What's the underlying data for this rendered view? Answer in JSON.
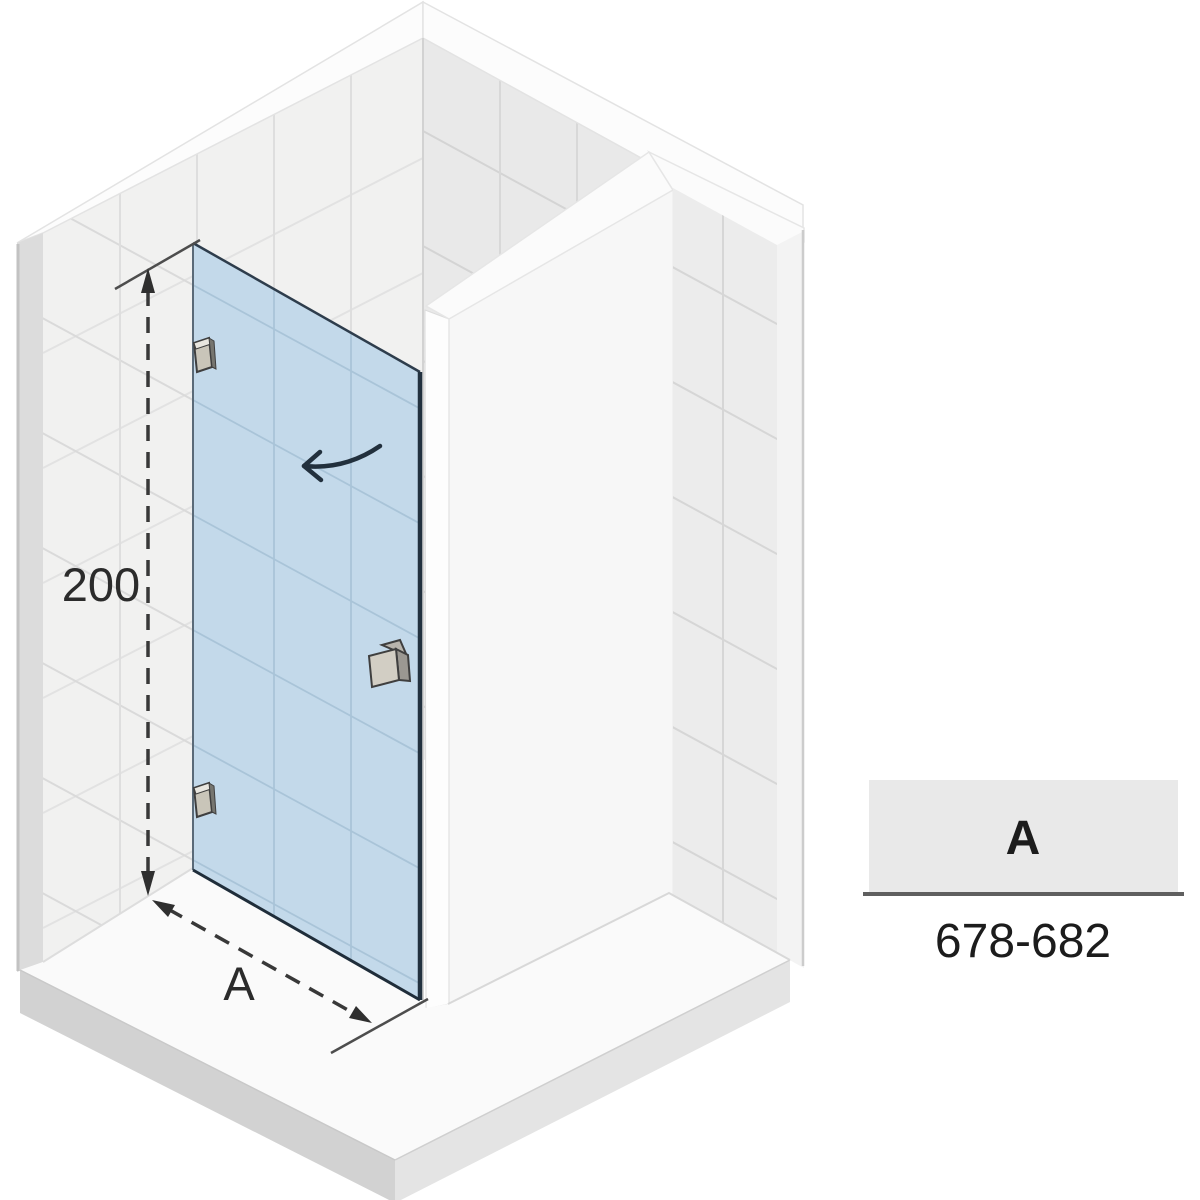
{
  "dimensions": {
    "height_label": "200",
    "width_label": "A"
  },
  "table": {
    "header": "A",
    "value": "678-682"
  },
  "icons": {
    "door_swing_arrow": "curved-arrow-left",
    "height_dimension_arrows": "dashed-double-arrow-vertical",
    "width_dimension_arrows": "dashed-double-arrow-diagonal"
  },
  "colors": {
    "glass": "#c3d9ea",
    "glass_line": "#a9c4d8",
    "glass_edge": "#22313f",
    "wall_tile_left": "#f1f1f0",
    "wall_tile_right": "#e9e9e9",
    "wall_cap": "#fcfcfc",
    "tile_joint": "#d9d9d9",
    "tray_top": "#fafafa",
    "tray_side_dark": "#d2d2d2",
    "tray_side_light": "#e4e4e4",
    "dimension_line": "#383838",
    "table_header_bg": "#e9e9e9",
    "table_rule": "#5f5f5f",
    "text": "#2b2b2b"
  }
}
